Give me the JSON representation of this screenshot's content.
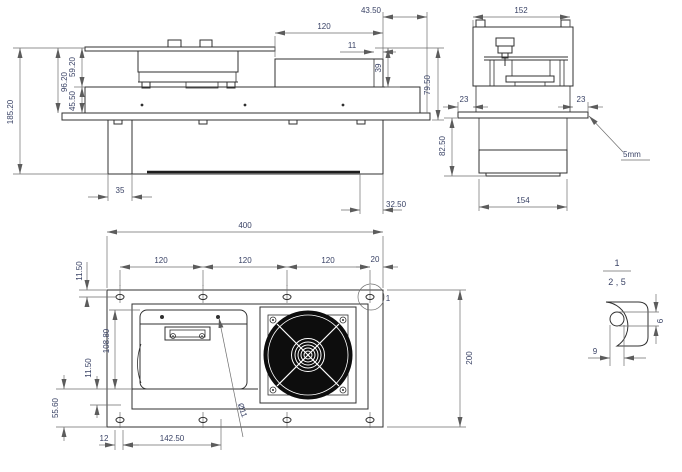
{
  "colors": {
    "background": "#ffffff",
    "geometry_line": "#303030",
    "dimension_line": "#6e6e6e",
    "dimension_text": "#3a4366",
    "fan_fill": "#0d0d0d"
  },
  "dims": {
    "side": {
      "height_total": "185.20",
      "height_upper": "96.20",
      "height_module": "59.20",
      "height_mid": "45.50",
      "offset_top": "43.50",
      "width_module": "120",
      "width_tab": "11",
      "height_box": "39",
      "height_right": "79.50",
      "foot_left": "35",
      "foot_right": "32.50"
    },
    "end": {
      "width_top": "152",
      "overhang_left": "23",
      "overhang_right": "23",
      "height_lower": "82.50",
      "width_bottom": "154",
      "plate_note": "5mm"
    },
    "plan": {
      "width_total": "400",
      "pitch_1": "120",
      "pitch_2": "120",
      "pitch_3": "120",
      "edge_offset": "20",
      "margin_top": "11.50",
      "panel_height": "108.80",
      "margin_bottom": "11.50",
      "strip_height": "55.60",
      "offset_left": "12",
      "slot_span": "142.50",
      "hole_dia": "Ø11",
      "height_total": "200",
      "detail_label": "1"
    },
    "detail": {
      "label": "1",
      "scale": "2 , 5",
      "slot_width": "9",
      "slot_height": "6"
    }
  }
}
